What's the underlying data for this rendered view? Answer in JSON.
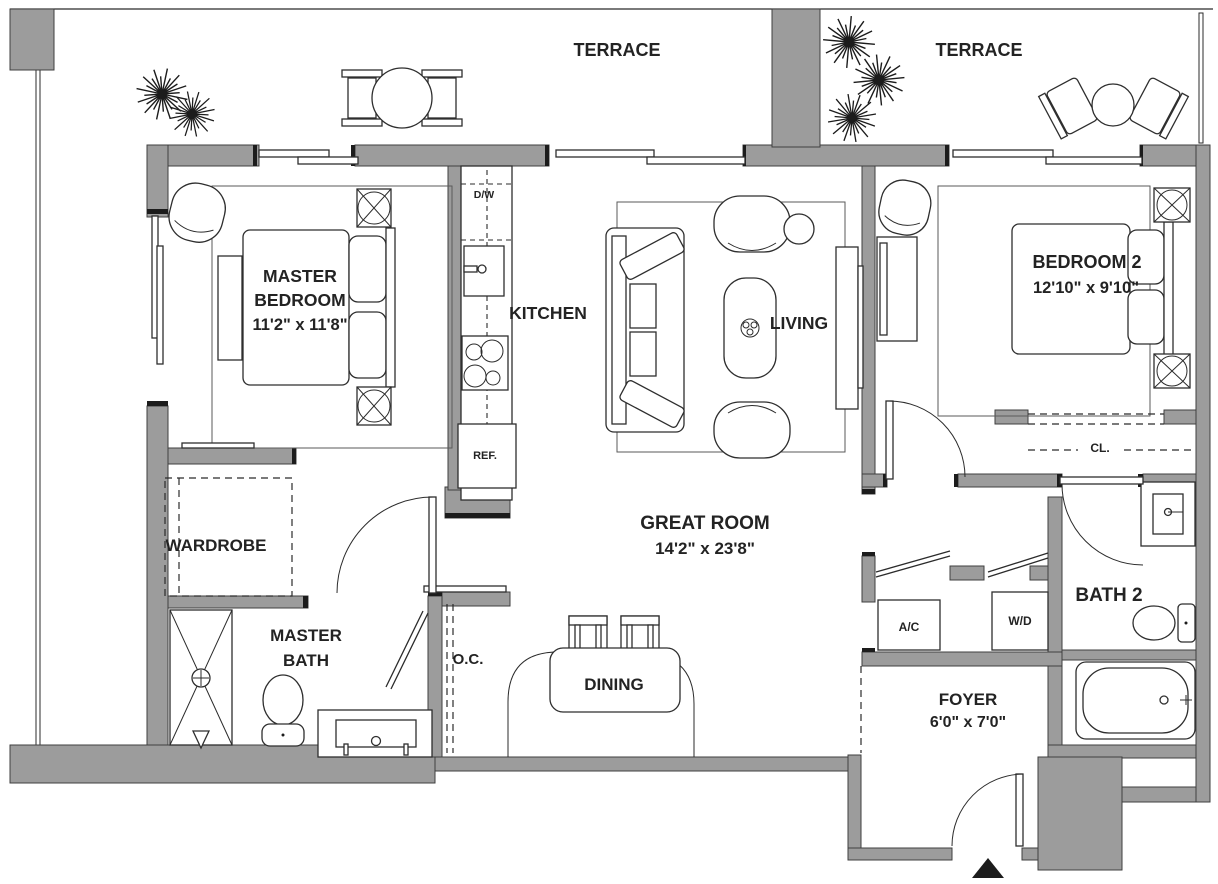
{
  "meta": {
    "type": "apartment-floor-plan",
    "colors": {
      "wall": "#9c9c9c",
      "line": "#2b2b2b",
      "text": "#232323",
      "background": "#ffffff"
    }
  },
  "labels": {
    "terrace_left": "TERRACE",
    "terrace_right": "TERRACE",
    "master_bedroom_line1": "MASTER",
    "master_bedroom_line2": "BEDROOM",
    "master_bedroom_dims": "11'2\" x 11'8\"",
    "kitchen": "KITCHEN",
    "living": "LIVING",
    "bedroom2": "BEDROOM 2",
    "bedroom2_dims": "12'10\" x 9'10\"",
    "wardrobe": "WARDROBE",
    "great_room": "GREAT ROOM",
    "great_room_dims": "14'2\" x 23'8\"",
    "master_bath_line1": "MASTER",
    "master_bath_line2": "BATH",
    "oc": "O.C.",
    "dining": "DINING",
    "ac": "A/C",
    "wd": "W/D",
    "bath2": "BATH 2",
    "foyer": "FOYER",
    "foyer_dims": "6'0\" x  7'0\"",
    "closet": "CL.",
    "dishwasher": "D/W",
    "refrigerator": "REF."
  }
}
